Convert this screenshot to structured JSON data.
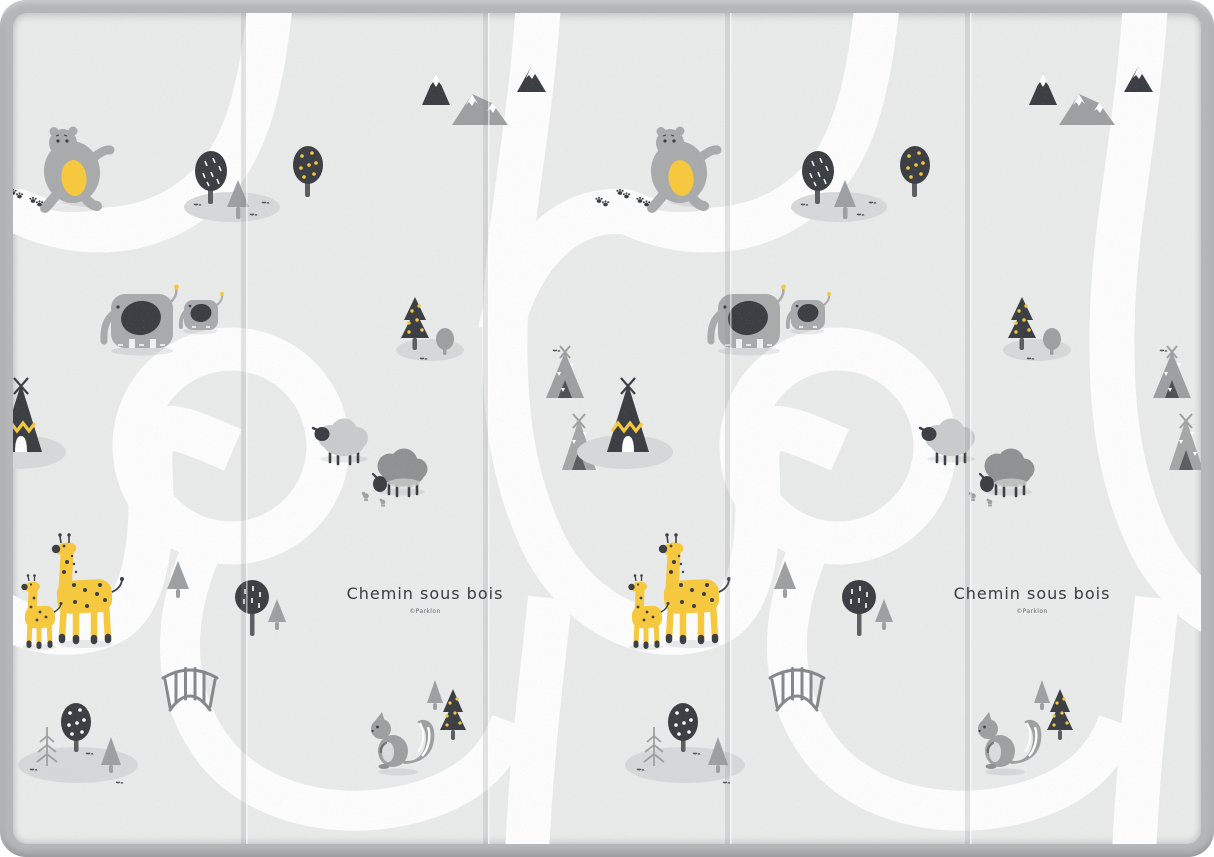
{
  "mat": {
    "title_label": "Chemin sous bois",
    "credit_label": "©Parklon",
    "pattern_repeats": 2,
    "fold_lines": 4,
    "motifs": [
      "bear-icon",
      "elephant-icons",
      "giraffe-icons",
      "sheep-icons",
      "teepee-icons",
      "mountain-icons",
      "tree-icons",
      "squirrel-icon",
      "bridge-icon",
      "road-paths",
      "paw-print-icons",
      "bird-icons"
    ],
    "colors": {
      "border": "#b5b6b8",
      "surface": "#e8e9e9",
      "road": "#fcfcfc",
      "yellow": "#f6c83e",
      "dark": "#3b3f43",
      "animal": "#a8aaac",
      "pine": "#9da0a2",
      "fleece": "#c9cacb",
      "fleece2": "#8f9193",
      "island": "#d6d7d8",
      "trunk": "#5b5e61",
      "rail": "#85888a",
      "text": "#393d41"
    }
  }
}
